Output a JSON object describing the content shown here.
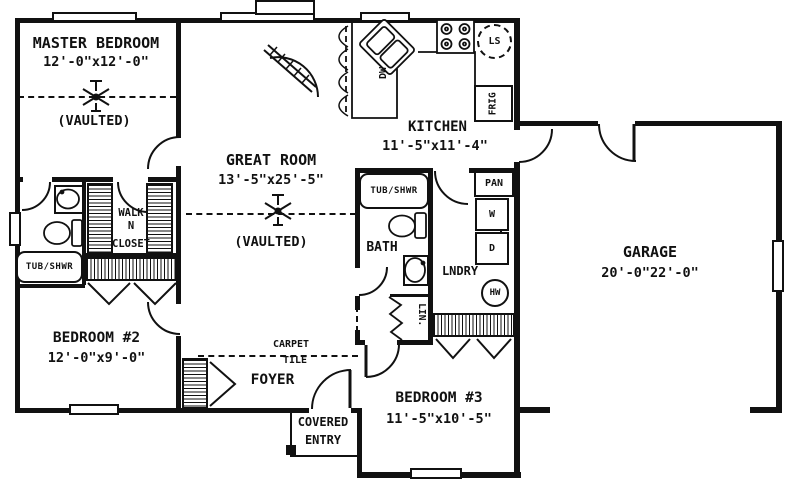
{
  "rooms": {
    "master_bedroom": {
      "name": "MASTER BEDROOM",
      "dims": "12'-0\"x12'-0\"",
      "ceiling": "(VAULTED)"
    },
    "great_room": {
      "name": "GREAT ROOM",
      "dims": "13'-5\"x25'-5\"",
      "ceiling": "(VAULTED)"
    },
    "kitchen": {
      "name": "KITCHEN",
      "dims": "11'-5\"x11'-4\""
    },
    "garage": {
      "name": "GARAGE",
      "dims": "20'-0\"22'-0\""
    },
    "bedroom2": {
      "name": "BEDROOM #2",
      "dims": "12'-0\"x9'-0\""
    },
    "bedroom3": {
      "name": "BEDROOM #3",
      "dims": "11'-5\"x10'-5\""
    },
    "bath": {
      "name": "BATH"
    },
    "laundry": {
      "name": "LNDRY"
    },
    "foyer": {
      "name": "FOYER"
    },
    "covered_entry": {
      "line1": "COVERED",
      "line2": "ENTRY"
    },
    "walk_in_closet": {
      "line1": "WALK",
      "line2": "N",
      "line3": "CLOSET"
    }
  },
  "fixtures": {
    "master_tub": "TUB/SHWR",
    "hall_tub": "TUB/SHWR",
    "pantry": "PAN",
    "washer": "W",
    "dryer": "D",
    "water_heater": "HW",
    "lazy_susan": "LS",
    "refrigerator": "FRIG",
    "dishwasher": "DW",
    "linen": "LIN."
  },
  "floor_labels": {
    "carpet": "CARPET",
    "tile": "TILE"
  },
  "colors": {
    "ink": "#111111",
    "paper": "#ffffff"
  }
}
